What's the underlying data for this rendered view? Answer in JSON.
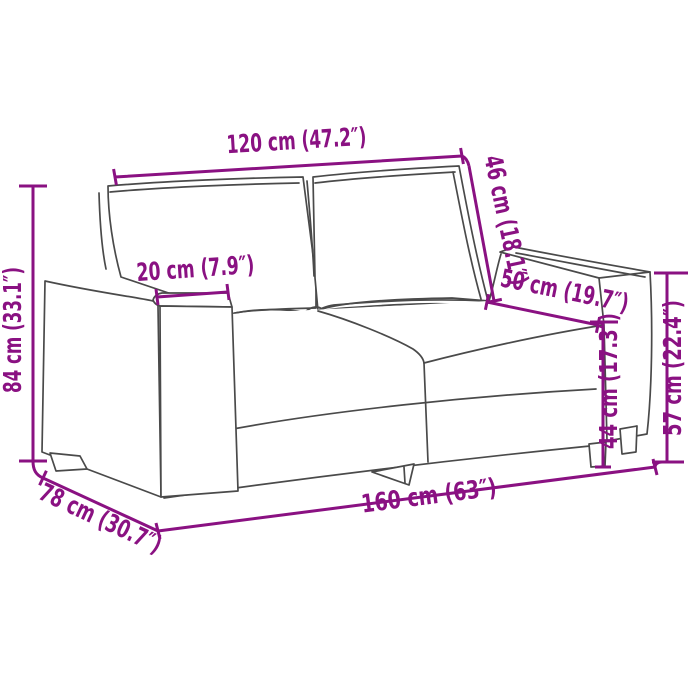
{
  "figure": {
    "type": "product-dimension-diagram",
    "subject": "two-seater sofa line drawing with measurements",
    "accent_color": "#8A1182",
    "line_color": "#4A4A4A",
    "background_color": "#FFFFFF"
  },
  "dimensions": {
    "back_width": {
      "cm": "120 cm",
      "inches": "47.2″",
      "label": "120 cm (47.2″)"
    },
    "backrest_height": {
      "cm": "46 cm",
      "inches": "18.1″",
      "label": "46 cm (18.1″)"
    },
    "seat_depth": {
      "cm": "50 cm",
      "inches": "19.7″",
      "label": "50 cm (19.7″)"
    },
    "armrest_width": {
      "cm": "20 cm",
      "inches": "7.9″",
      "label": "20 cm (7.9″)"
    },
    "overall_height": {
      "cm": "84 cm",
      "inches": "33.1″",
      "label": "84 cm (33.1″)"
    },
    "overall_depth": {
      "cm": "78 cm",
      "inches": "30.7″",
      "label": "78 cm (30.7″)"
    },
    "overall_width": {
      "cm": "160 cm",
      "inches": "63″",
      "label": "160 cm (63″)"
    },
    "seat_height": {
      "cm": "44 cm",
      "inches": "17.3″",
      "label": "44 cm (17.3″)"
    },
    "armrest_height": {
      "cm": "57 cm",
      "inches": "22.4″",
      "label": "57 cm (22.4″)"
    }
  }
}
